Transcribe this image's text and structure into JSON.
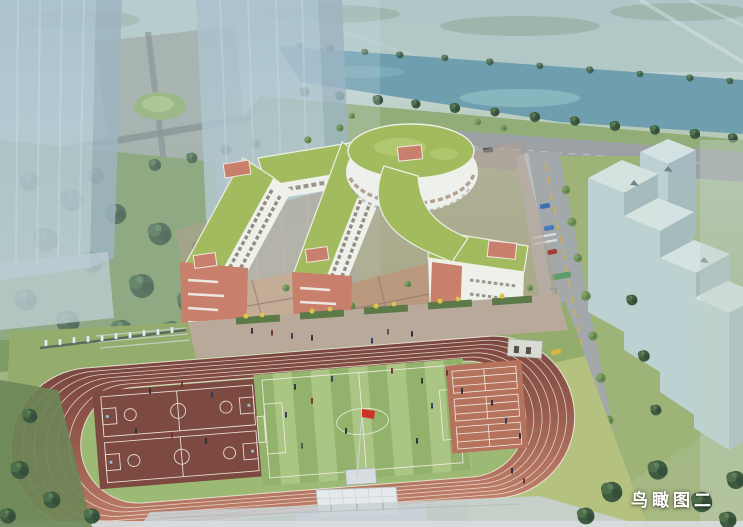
{
  "page": {
    "caption": "鸟瞰图二",
    "caption_meaning": "Bird's-eye view No.2"
  },
  "scene": {
    "type": "architectural-aerial-rendering",
    "subject": "school campus with sports ground, green-roof teaching buildings, riverfront and ghosted context towers",
    "elements": [
      "river",
      "far-bank-trees",
      "near-bank-trees",
      "north-road",
      "ghost-tower-left",
      "ghost-tower-right",
      "tree-cluster-west",
      "round-building",
      "teaching-building-wings",
      "courtyards",
      "rooftop-stair-boxes",
      "entrance-street-east",
      "massing-blocks-east",
      "running-track",
      "football-pitch",
      "basketball-courts",
      "tennis-volleyball-courts",
      "grandstand",
      "flagpole-china-flag",
      "west-fence",
      "caption-text"
    ],
    "colors": {
      "sky_haze": "#c6d8e0",
      "water": "#6f9fae",
      "far_field_green": "#a9c0b0",
      "roof_green": "#a3bb5f",
      "facade_white": "#eef0ea",
      "facade_terracotta": "#c87f6b",
      "courtyard_paving": "#c4ad97",
      "track_dark": "#7a463d",
      "track_light": "#c08069",
      "lane_line": "#f1ebe3",
      "infield_green": "#9cba74",
      "pitch_stripe_light": "#abc684",
      "pitch_stripe_dark": "#93b26c",
      "basketball_court": "#7c4a40",
      "tennis_court": "#b5725c",
      "lawn_green": "#94ad6d",
      "lawn_yellow_green": "#bac482",
      "tree_dark": "#3e5a40",
      "tree_light": "#6d8f55",
      "road_gray": "#9ba1a4",
      "massing_top": "#d6e4e4",
      "massing_front": "#bed2d4",
      "massing_side": "#a6bcc0",
      "tower_glass": "#a7bfcb",
      "grandstand_white": "#e4e9ec",
      "flag_red": "#cf3227",
      "caption_white": "#ffffff"
    }
  }
}
